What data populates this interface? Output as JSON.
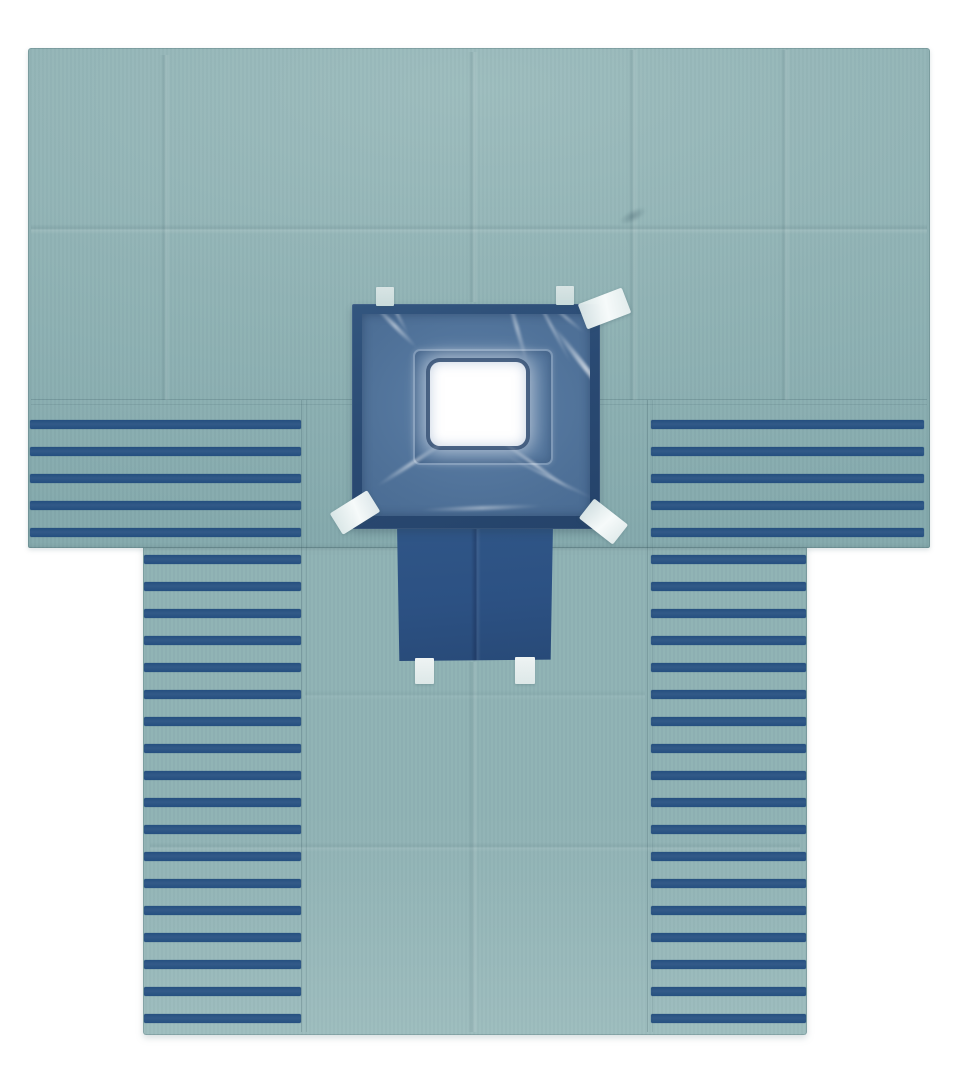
{
  "scene": {
    "description": "Product photo on a white background of a folded teal surgical fenestrated drape shaped like a T. Both sides carry bands of horizontal navy stripes: five wide stripes across each upper wing and eighteen narrower stripes down each lower column. In the upper center a navy adhesive panel holds a glossy clear incise film with a white square fenestration opening; small light tabs sit above the panel and white fixation tapes are stuck at angles on its corners. A navy instrument pouch hangs below the panel with two white tape tabs at its bottom edge. Fold creases and stitched seams cross the fabric."
  },
  "colors": {
    "background": "#ffffff",
    "fabric": "#8fb2b4",
    "fabric-light": "#9dbdbe",
    "fabric-dark": "#84a9ac",
    "stripe": "#1f4a7d",
    "stripe-light": "#2d5586",
    "panel": "#2a4a73",
    "panel-light": "#33567f",
    "panel-dark": "#25436a",
    "film": "#4f7198",
    "film-light": "#5d80a8",
    "film-dark": "#44668e",
    "pouch": "#2c5183",
    "pouch-light": "#305687",
    "pouch-dark": "#284a78",
    "tape": "#f6fafa",
    "tab": "#d8e4e4",
    "aperture": "#ffffff"
  },
  "drape": {
    "stripes": {
      "height": 9,
      "spacing": 27,
      "regions": [
        {
          "name": "left-wing-stripes",
          "x": 30,
          "width": 271,
          "start_y": 420,
          "count": 5
        },
        {
          "name": "right-wing-stripes",
          "x": 651,
          "width": 273,
          "start_y": 420,
          "count": 5
        },
        {
          "name": "left-column-stripes",
          "x": 144,
          "width": 157,
          "start_y": 555,
          "count": 18
        },
        {
          "name": "right-column-stripes",
          "x": 651,
          "width": 155,
          "start_y": 555,
          "count": 18
        }
      ]
    }
  },
  "film_streaks": [
    {
      "left": 2,
      "top": 10,
      "width": 62,
      "height": 4,
      "rotate": 45,
      "opacity": 0.65
    },
    {
      "left": 10,
      "top": -2,
      "width": 50,
      "height": 3,
      "rotate": 62,
      "opacity": 0.45
    },
    {
      "left": 118,
      "top": 12,
      "width": 74,
      "height": 4,
      "rotate": 74,
      "opacity": 0.55
    },
    {
      "left": 146,
      "top": 10,
      "width": 86,
      "height": 3,
      "rotate": 62,
      "opacity": 0.5
    },
    {
      "left": 168,
      "top": 52,
      "width": 112,
      "height": 5,
      "rotate": 52,
      "opacity": 0.8
    },
    {
      "left": 180,
      "top": 2,
      "width": 48,
      "height": 3,
      "rotate": 40,
      "opacity": 0.45
    },
    {
      "left": 8,
      "top": 148,
      "width": 82,
      "height": 4,
      "rotate": -33,
      "opacity": 0.6
    },
    {
      "left": 128,
      "top": 150,
      "width": 92,
      "height": 3,
      "rotate": 35,
      "opacity": 0.65
    },
    {
      "left": 138,
      "top": 162,
      "width": 100,
      "height": 3,
      "rotate": 26,
      "opacity": 0.45
    },
    {
      "left": 58,
      "top": 192,
      "width": 124,
      "height": 4,
      "rotate": -2,
      "opacity": 0.5
    }
  ]
}
